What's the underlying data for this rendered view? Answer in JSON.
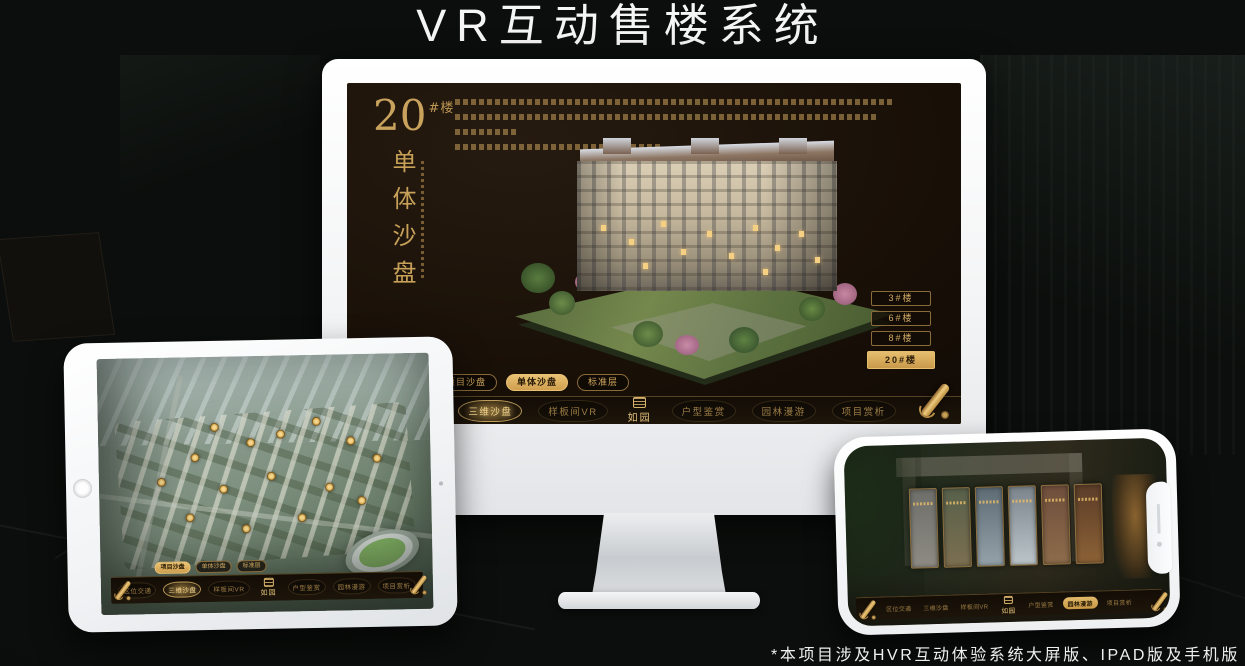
{
  "title": "VR互动售楼系统",
  "footnote": "*本项目涉及HVR互动体验系统大屏版、IPAD版及手机版",
  "brand": {
    "logo": "如园"
  },
  "colors": {
    "accent_gold": "#c9a35e",
    "selected_gold": "#d9ae5f",
    "screen_bg": "#180f07",
    "device_white": "#f5f6f7"
  },
  "nav_items": [
    {
      "label": "区位交通"
    },
    {
      "label": "三维沙盘"
    },
    {
      "label": "样板间VR"
    },
    {
      "label": "户型鉴赏"
    },
    {
      "label": "园林漫游"
    },
    {
      "label": "项目赏析"
    }
  ],
  "sub_tabs": [
    {
      "label": "项目沙盘"
    },
    {
      "label": "单体沙盘"
    },
    {
      "label": "标准层"
    }
  ],
  "monitor": {
    "building_number": "20",
    "building_unit": "#楼",
    "section_title": "单体沙盘",
    "floor_buttons": [
      {
        "label": "3#楼"
      },
      {
        "label": "6#楼"
      },
      {
        "label": "8#楼"
      },
      {
        "label": "20#楼"
      }
    ]
  }
}
